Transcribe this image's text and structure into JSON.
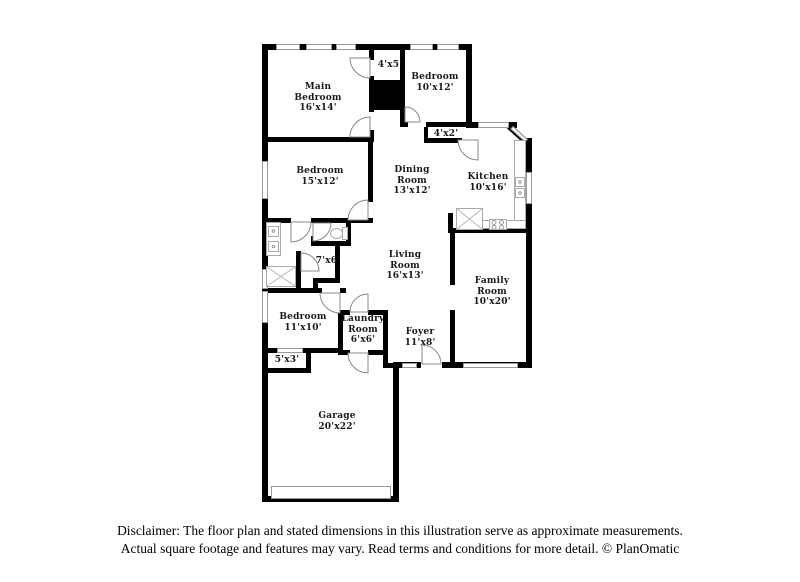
{
  "page": {
    "background": "#ffffff"
  },
  "plan": {
    "rooms": [
      {
        "id": "main-bedroom",
        "label": "Main\nBedroom\n16'x14'"
      },
      {
        "id": "closet-4x5",
        "label": "4'x5'"
      },
      {
        "id": "bedroom-10x12",
        "label": "Bedroom\n10'x12'"
      },
      {
        "id": "closet-4x2",
        "label": "4'x2'"
      },
      {
        "id": "bedroom-15x12",
        "label": "Bedroom\n15'x12'"
      },
      {
        "id": "dining-room",
        "label": "Dining\nRoom\n13'x12'"
      },
      {
        "id": "kitchen",
        "label": "Kitchen\n10'x16'"
      },
      {
        "id": "bathroom-7x6",
        "label": "7'x6'"
      },
      {
        "id": "living-room",
        "label": "Living\nRoom\n16'x13'"
      },
      {
        "id": "family-room",
        "label": "Family\nRoom\n10'x20'"
      },
      {
        "id": "bedroom-11x10",
        "label": "Bedroom\n11'x10'"
      },
      {
        "id": "laundry-room",
        "label": "Laundry\nRoom\n6'x6'"
      },
      {
        "id": "foyer",
        "label": "Foyer\n11'x8'"
      },
      {
        "id": "closet-5x3",
        "label": "5'x3'"
      },
      {
        "id": "garage",
        "label": "Garage\n20'x22'"
      }
    ],
    "colors": {
      "wall": "#000000",
      "window_border": "#999999",
      "fixture_border": "#aaaaaa",
      "door_arc": "#888888",
      "label_text": "#1a1a1a"
    }
  },
  "disclaimer": {
    "line1": "Disclaimer: The floor plan and stated dimensions in this illustration serve as approximate measurements.",
    "line2": "Actual square footage and features may vary. Read terms and conditions for more detail. © PlanOmatic"
  }
}
